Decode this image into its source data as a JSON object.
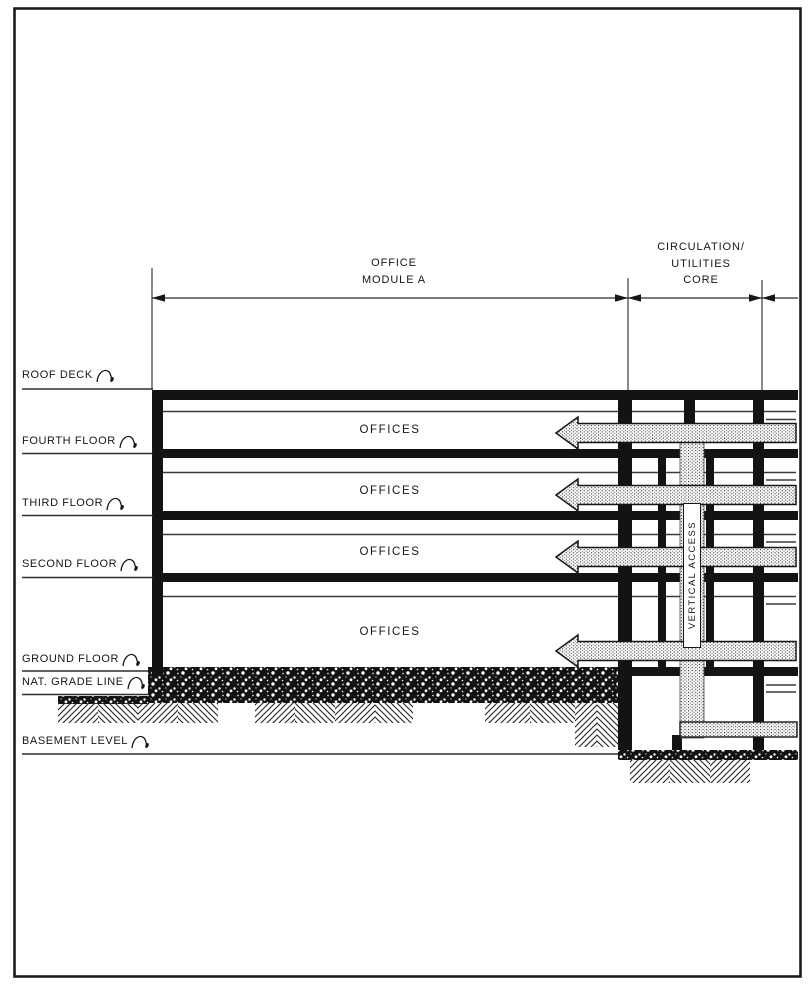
{
  "colors": {
    "ink": "#161616",
    "paper": "#ffffff"
  },
  "dimension_labels": {
    "module_a_line1": "OFFICE",
    "module_a_line2": "MODULE A",
    "core_line1": "CIRCULATION/",
    "core_line2": "UTILITIES",
    "core_line3": "CORE"
  },
  "level_labels": [
    {
      "label": "ROOF DECK"
    },
    {
      "label": "FOURTH FLOOR"
    },
    {
      "label": "THIRD FLOOR"
    },
    {
      "label": "SECOND FLOOR"
    },
    {
      "label": "GROUND FLOOR"
    },
    {
      "label": "NAT. GRADE LINE"
    },
    {
      "label": "BASEMENT LEVEL"
    }
  ],
  "room_labels": {
    "office": "OFFICES",
    "vertical_access": "VERTICAL ACCESS"
  }
}
